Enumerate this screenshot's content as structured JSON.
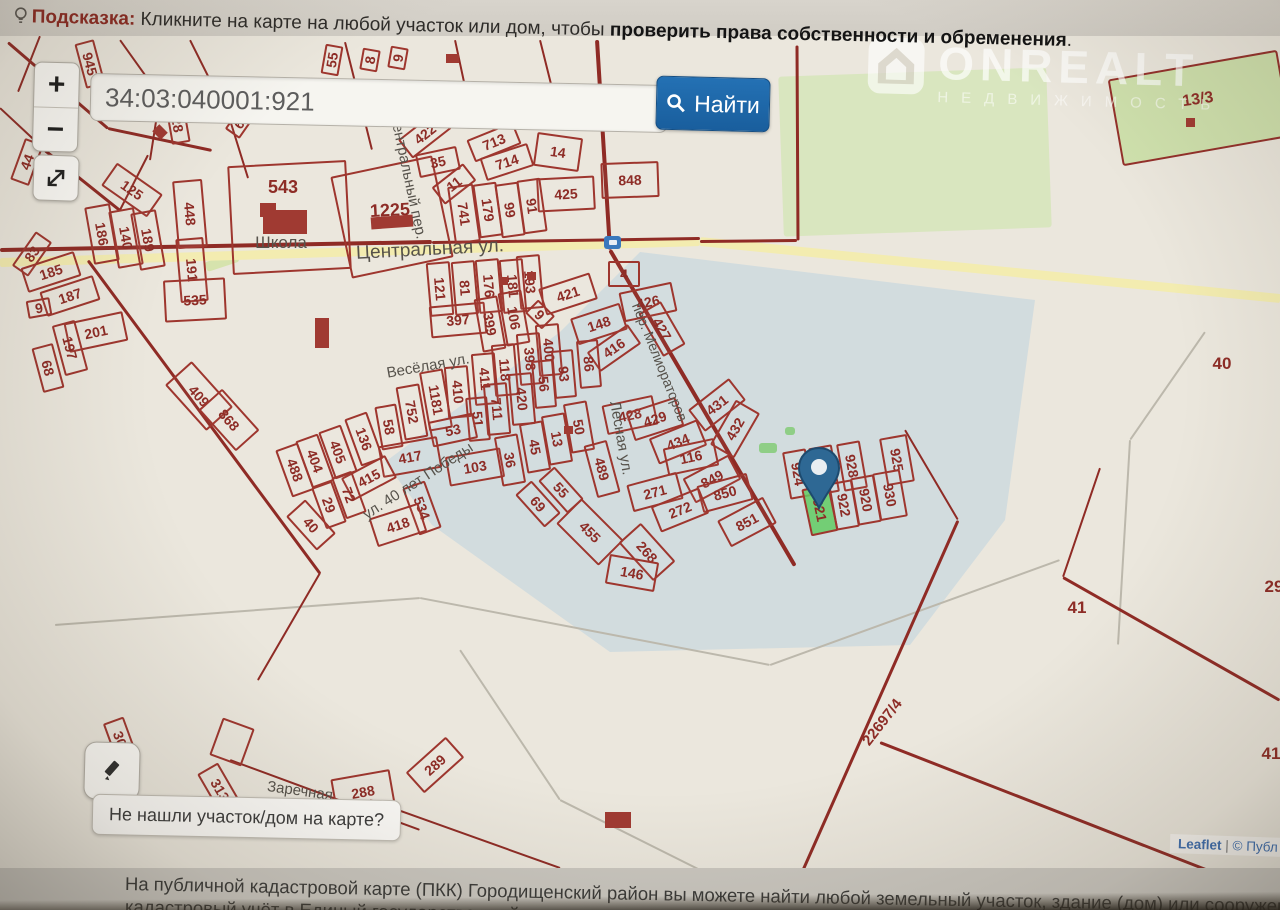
{
  "hint_bar": {
    "prefix": "Подсказка:",
    "text": " Кликните на карте на любой участок или дом, чтобы ",
    "bold": "проверить права собственности и обременения",
    "suffix": "."
  },
  "search": {
    "query": "34:03:040001:921",
    "button_label": "Найти"
  },
  "zoom_controls": {
    "zoom_in": "+",
    "zoom_out": "−"
  },
  "watermark": {
    "title": "ONREALT",
    "subtitle": "НЕДВИЖИМОСТЬ"
  },
  "not_found_bubble": "Не нашли участок/дом на карте?",
  "attribution": {
    "leaflet": "Leaflet",
    "separator": "|",
    "rest": "© Публ"
  },
  "footer": {
    "line1": "На публичной кадастровой карте (ПКК) Городищенский район вы можете найти любой земельный участок, здание (дом) или сооружение, которые пос",
    "line2": "кадастровый учёт в Единый государственный"
  },
  "colors": {
    "parcel_border": "#9e362e",
    "selected_parcel_fill": "#63cb63",
    "accent_blue": "#1d66a8",
    "road_yellow": "#f3ecb0",
    "green_area": "#d9e6bf"
  },
  "map": {
    "selected_parcel": "34:03:040001:921",
    "marker": {
      "x": 819,
      "y": 508
    },
    "parcels": [
      [
        "945",
        88,
        62,
        42,
        16,
        75
      ],
      [
        "28",
        176,
        122,
        34,
        15,
        80
      ],
      [
        "6",
        237,
        122,
        20,
        14,
        -55
      ],
      [
        "44",
        25,
        160,
        40,
        16,
        -70
      ],
      [
        "125",
        130,
        188,
        52,
        24,
        35
      ],
      [
        "448",
        188,
        212,
        64,
        26,
        85
      ],
      [
        "191",
        190,
        268,
        60,
        24,
        85
      ],
      [
        "186",
        100,
        232,
        54,
        22,
        80
      ],
      [
        "140",
        124,
        236,
        54,
        22,
        80
      ],
      [
        "189",
        146,
        238,
        54,
        22,
        80
      ],
      [
        "83",
        30,
        252,
        38,
        16,
        -55
      ],
      [
        "185",
        49,
        270,
        52,
        22,
        -18
      ],
      [
        "187",
        68,
        294,
        52,
        22,
        -18
      ],
      [
        "9",
        37,
        306,
        20,
        14,
        -10
      ],
      [
        "201",
        94,
        330,
        56,
        26,
        -12
      ],
      [
        "197",
        68,
        346,
        48,
        20,
        75
      ],
      [
        "68",
        46,
        366,
        42,
        18,
        75
      ],
      [
        "535",
        193,
        298,
        58,
        38,
        -3
      ],
      [
        "",
        287,
        215,
        115,
        105,
        -3,
        "blank"
      ],
      [
        "543",
        283,
        187,
        40,
        20,
        0,
        "nb",
        18
      ],
      [
        "",
        390,
        215,
        100,
        100,
        -12,
        "blank"
      ],
      [
        "1225",
        390,
        210,
        70,
        26,
        -3,
        "nb",
        18
      ],
      [
        "55",
        330,
        58,
        26,
        14,
        -80
      ],
      [
        "8",
        368,
        58,
        18,
        14,
        -80
      ],
      [
        "9",
        396,
        56,
        18,
        14,
        -80
      ],
      [
        "422",
        423,
        132,
        46,
        20,
        -38
      ],
      [
        "35",
        436,
        160,
        38,
        20,
        -12
      ],
      [
        "11",
        452,
        182,
        36,
        18,
        -38
      ],
      [
        "713",
        492,
        140,
        46,
        20,
        -22
      ],
      [
        "714",
        505,
        160,
        46,
        20,
        -18
      ],
      [
        "14",
        556,
        150,
        42,
        30,
        8
      ],
      [
        "848",
        628,
        178,
        54,
        32,
        -2
      ],
      [
        "425",
        564,
        192,
        54,
        30,
        -3
      ],
      [
        "741",
        462,
        212,
        54,
        22,
        82
      ],
      [
        "179",
        486,
        208,
        50,
        20,
        82
      ],
      [
        "99",
        508,
        208,
        50,
        20,
        82
      ],
      [
        "91",
        530,
        204,
        50,
        20,
        82
      ],
      [
        "4",
        622,
        272,
        28,
        22,
        0
      ],
      [
        "421",
        566,
        292,
        50,
        24,
        -18
      ],
      [
        "193",
        528,
        280,
        50,
        20,
        85
      ],
      [
        "181",
        511,
        284,
        50,
        20,
        85
      ],
      [
        "176",
        487,
        284,
        50,
        20,
        85
      ],
      [
        "81",
        463,
        286,
        50,
        20,
        85
      ],
      [
        "121",
        438,
        287,
        50,
        20,
        85
      ],
      [
        "397",
        456,
        318,
        52,
        28,
        -5
      ],
      [
        "399",
        488,
        322,
        50,
        20,
        80
      ],
      [
        "106",
        512,
        316,
        50,
        20,
        80
      ],
      [
        "9",
        538,
        312,
        20,
        15,
        45
      ],
      [
        "148",
        597,
        322,
        48,
        24,
        -18
      ],
      [
        "426",
        646,
        300,
        50,
        26,
        -12
      ],
      [
        "427",
        660,
        327,
        46,
        22,
        60
      ],
      [
        "416",
        612,
        346,
        46,
        20,
        -35
      ],
      [
        "400",
        547,
        348,
        48,
        20,
        85
      ],
      [
        "398",
        528,
        357,
        48,
        20,
        85
      ],
      [
        "118",
        503,
        368,
        48,
        20,
        85
      ],
      [
        "411",
        483,
        377,
        48,
        20,
        85
      ],
      [
        "410",
        456,
        390,
        48,
        20,
        85
      ],
      [
        "420",
        520,
        397,
        48,
        20,
        85
      ],
      [
        "711",
        495,
        407,
        48,
        20,
        85
      ],
      [
        "51",
        476,
        417,
        40,
        18,
        85
      ],
      [
        "1181",
        434,
        398,
        56,
        20,
        80
      ],
      [
        "752",
        410,
        410,
        50,
        20,
        80
      ],
      [
        "58",
        387,
        425,
        40,
        18,
        80
      ],
      [
        "53",
        451,
        428,
        42,
        22,
        -12
      ],
      [
        "56",
        542,
        382,
        44,
        18,
        85
      ],
      [
        "93",
        562,
        372,
        44,
        18,
        85
      ],
      [
        "86",
        587,
        362,
        44,
        18,
        85
      ],
      [
        "417",
        408,
        455,
        56,
        28,
        -10
      ],
      [
        "103",
        473,
        465,
        52,
        26,
        -10
      ],
      [
        "36",
        508,
        458,
        46,
        20,
        80
      ],
      [
        "45",
        533,
        445,
        46,
        20,
        80
      ],
      [
        "13",
        555,
        437,
        46,
        20,
        80
      ],
      [
        "50",
        577,
        425,
        46,
        20,
        80
      ],
      [
        "489",
        600,
        467,
        50,
        20,
        75
      ],
      [
        "55",
        559,
        488,
        40,
        18,
        48
      ],
      [
        "69",
        536,
        502,
        40,
        18,
        48
      ],
      [
        "455",
        588,
        530,
        56,
        32,
        45
      ],
      [
        "534",
        420,
        506,
        46,
        20,
        70
      ],
      [
        "418",
        396,
        523,
        48,
        26,
        -18
      ],
      [
        "488",
        293,
        468,
        46,
        20,
        70
      ],
      [
        "404",
        313,
        459,
        46,
        20,
        70
      ],
      [
        "405",
        336,
        450,
        46,
        20,
        70
      ],
      [
        "136",
        362,
        437,
        46,
        20,
        70
      ],
      [
        "415",
        367,
        476,
        46,
        22,
        -28
      ],
      [
        "72",
        347,
        493,
        40,
        18,
        70
      ],
      [
        "29",
        327,
        503,
        40,
        18,
        70
      ],
      [
        "40",
        309,
        523,
        42,
        22,
        48
      ],
      [
        "409",
        197,
        394,
        58,
        32,
        48
      ],
      [
        "868",
        227,
        418,
        52,
        28,
        48
      ],
      [
        "428",
        628,
        413,
        48,
        26,
        -12
      ],
      [
        "429",
        653,
        417,
        48,
        26,
        -18
      ],
      [
        "431",
        715,
        403,
        48,
        24,
        -38
      ],
      [
        "432",
        733,
        427,
        48,
        24,
        -60
      ],
      [
        "434",
        676,
        440,
        48,
        24,
        -22
      ],
      [
        "116",
        689,
        455,
        48,
        24,
        -12
      ],
      [
        "849",
        710,
        477,
        48,
        24,
        -28
      ],
      [
        "850",
        723,
        491,
        48,
        24,
        -15
      ],
      [
        "851",
        745,
        520,
        48,
        26,
        -28
      ],
      [
        "271",
        653,
        490,
        48,
        24,
        -15
      ],
      [
        "272",
        678,
        508,
        48,
        24,
        -22
      ],
      [
        "268",
        645,
        550,
        48,
        26,
        48
      ],
      [
        "146",
        630,
        571,
        46,
        26,
        10
      ],
      [
        "924",
        796,
        472,
        44,
        20,
        80
      ],
      [
        "926",
        822,
        468,
        44,
        20,
        80
      ],
      [
        "928",
        850,
        464,
        44,
        20,
        80
      ],
      [
        "925",
        895,
        458,
        44,
        24,
        80
      ],
      [
        "921",
        818,
        508,
        44,
        24,
        78,
        "sel"
      ],
      [
        "922",
        842,
        503,
        44,
        20,
        80
      ],
      [
        "920",
        864,
        498,
        44,
        20,
        80
      ],
      [
        "930",
        888,
        493,
        44,
        24,
        80
      ],
      [
        "13/3",
        1198,
        100,
        44,
        20,
        -8,
        "nb",
        16
      ],
      [
        "40",
        1222,
        363,
        30,
        20,
        0,
        "nb",
        17
      ],
      [
        "41",
        1077,
        607,
        30,
        20,
        0,
        "nb",
        17
      ],
      [
        "29",
        1274,
        586,
        24,
        20,
        0,
        "nb",
        17
      ],
      [
        "41",
        1271,
        753,
        24,
        20,
        0,
        "nb",
        17
      ],
      [
        "22697/4",
        882,
        722,
        80,
        20,
        -52,
        "nb",
        15
      ],
      [
        "30",
        118,
        737,
        36,
        18,
        70
      ],
      [
        "313",
        218,
        788,
        46,
        20,
        60
      ],
      [
        "288",
        361,
        790,
        56,
        32,
        -10
      ],
      [
        "289",
        433,
        763,
        50,
        24,
        -42
      ],
      [
        "",
        230,
        740,
        30,
        36,
        20,
        "blank"
      ]
    ],
    "streets": [
      [
        "Школа",
        281,
        243,
        0,
        17
      ],
      [
        "Центральная ул.",
        430,
        250,
        -3,
        19
      ],
      [
        "Центральный пер.",
        408,
        176,
        78,
        15
      ],
      [
        "Весёлая ул.",
        428,
        366,
        -10,
        15
      ],
      [
        "ул. 40 лет Победы",
        418,
        481,
        -33,
        15
      ],
      [
        "Лесная ул.",
        621,
        438,
        80,
        15
      ],
      [
        "пер. Мелиораторов",
        660,
        362,
        68,
        14
      ],
      [
        "Заречная",
        300,
        791,
        8,
        15
      ]
    ],
    "roads_yellow": [
      [
        0,
        262,
        700,
        241,
        9
      ],
      [
        700,
        241,
        1280,
        298,
        9
      ]
    ],
    "lines_red": [
      [
        597,
        40,
        610,
        250,
        4
      ],
      [
        610,
        250,
        795,
        566,
        4
      ],
      [
        958,
        520,
        786,
        908,
        3
      ],
      [
        905,
        430,
        958,
        520,
        2
      ],
      [
        1100,
        468,
        1063,
        577,
        2
      ],
      [
        1063,
        577,
        1280,
        700,
        3
      ],
      [
        880,
        742,
        1280,
        898,
        3
      ],
      [
        797,
        45,
        798,
        240,
        3
      ],
      [
        700,
        241,
        797,
        240,
        3
      ],
      [
        0,
        250,
        432,
        242,
        4
      ],
      [
        432,
        242,
        700,
        238,
        3
      ],
      [
        88,
        260,
        320,
        573,
        3
      ],
      [
        320,
        573,
        258,
        680,
        2
      ],
      [
        370,
        800,
        560,
        868,
        2
      ],
      [
        230,
        760,
        420,
        830,
        2
      ],
      [
        8,
        42,
        108,
        128,
        3
      ],
      [
        108,
        128,
        212,
        150,
        3
      ],
      [
        40,
        36,
        18,
        92,
        2
      ],
      [
        120,
        40,
        160,
        96,
        2
      ],
      [
        160,
        96,
        150,
        160,
        2
      ],
      [
        0,
        108,
        45,
        150,
        2
      ],
      [
        45,
        150,
        120,
        210,
        3
      ],
      [
        190,
        40,
        230,
        120,
        2
      ],
      [
        230,
        120,
        248,
        178,
        2
      ],
      [
        148,
        155,
        120,
        210,
        2
      ],
      [
        345,
        42,
        372,
        150,
        2
      ],
      [
        455,
        40,
        470,
        110,
        2
      ],
      [
        540,
        40,
        560,
        120,
        2
      ],
      [
        300,
        122,
        598,
        102,
        2
      ]
    ],
    "lines_gray": [
      [
        55,
        625,
        420,
        598,
        2
      ],
      [
        420,
        598,
        770,
        665,
        2
      ],
      [
        770,
        665,
        1060,
        560,
        2
      ],
      [
        1205,
        332,
        1130,
        440,
        2
      ],
      [
        1130,
        440,
        1118,
        645,
        2
      ],
      [
        460,
        650,
        560,
        800,
        2
      ],
      [
        560,
        800,
        700,
        870,
        2
      ]
    ],
    "greens": [
      [
        915,
        152,
        268,
        160,
        -2,
        "#d9e6bf",
        0
      ],
      [
        1198,
        106,
        168,
        84,
        -10,
        "#cfe1ad",
        2
      ],
      [
        768,
        448,
        18,
        10,
        0,
        "#8fce86",
        0
      ],
      [
        790,
        431,
        10,
        8,
        0,
        "#8fce86",
        0
      ],
      [
        222,
        262,
        34,
        10,
        -18,
        "#d6e3ad",
        0
      ]
    ],
    "buildings": [
      [
        285,
        222,
        44,
        24,
        0
      ],
      [
        268,
        210,
        16,
        14,
        0
      ],
      [
        392,
        222,
        42,
        12,
        -4
      ],
      [
        322,
        333,
        14,
        30,
        0
      ],
      [
        489,
        108,
        16,
        12,
        40
      ],
      [
        546,
        117,
        13,
        10,
        40
      ],
      [
        452,
        58,
        13,
        9,
        0
      ],
      [
        618,
        820,
        26,
        16,
        0
      ],
      [
        503,
        281,
        9,
        8,
        0
      ],
      [
        531,
        276,
        9,
        8,
        0
      ],
      [
        568,
        430,
        9,
        8,
        0
      ],
      [
        160,
        132,
        12,
        10,
        45
      ],
      [
        1190,
        122,
        9,
        9,
        0
      ]
    ]
  }
}
